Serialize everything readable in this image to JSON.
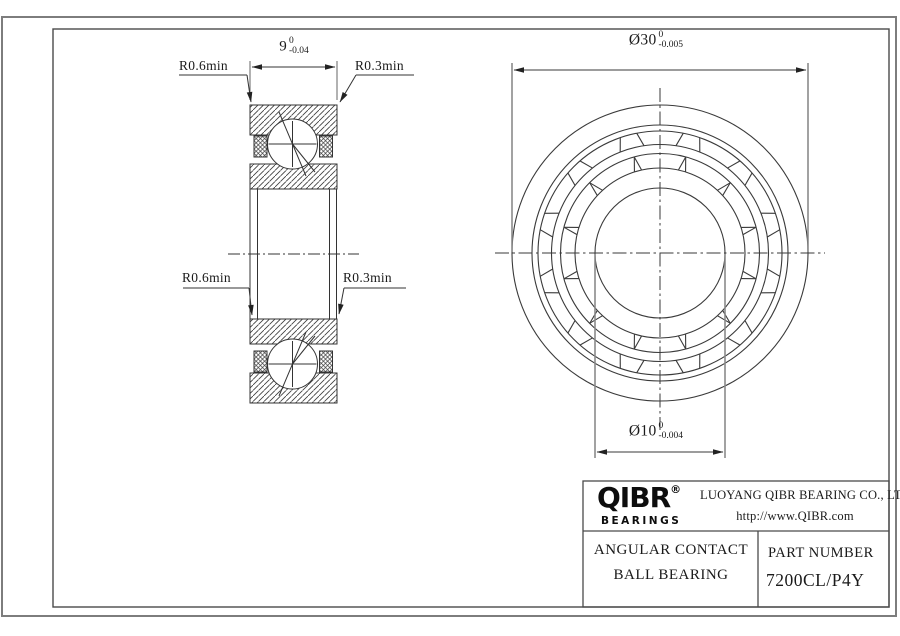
{
  "drawing": {
    "section_view": {
      "radius_labels": {
        "top_left": "R0.6min",
        "top_right": "R0.3min",
        "bottom_left": "R0.6min",
        "bottom_right": "R0.3min"
      },
      "width_dim": {
        "value": "9",
        "tol_upper": "0",
        "tol_lower": "-0.04"
      }
    },
    "front_view": {
      "outer_dia_dim": {
        "value": "Ø30",
        "tol_upper": "0",
        "tol_lower": "-0.005"
      },
      "bore_dia_dim": {
        "value": "Ø10",
        "tol_upper": "0",
        "tol_lower": "-0.004"
      }
    }
  },
  "title_block": {
    "logo_text": "QIBR",
    "registered_mark": "®",
    "logo_subtext": "BEARINGS",
    "company_name": "LUOYANG QIBR BEARING CO., LTD",
    "website": "http://www.QIBR.com",
    "product_name_line1": "ANGULAR CONTACT",
    "product_name_line2": "BALL BEARING",
    "part_number_label": "PART NUMBER",
    "part_number": "7200CL/P4Y"
  },
  "colors": {
    "background": "#ffffff",
    "drawing_line": "#333333",
    "frame_outer": "#7d7d7d",
    "frame_inner": "#4a4a4a",
    "extension_line": "#8a8a8a",
    "text": "#1a1a1a"
  }
}
